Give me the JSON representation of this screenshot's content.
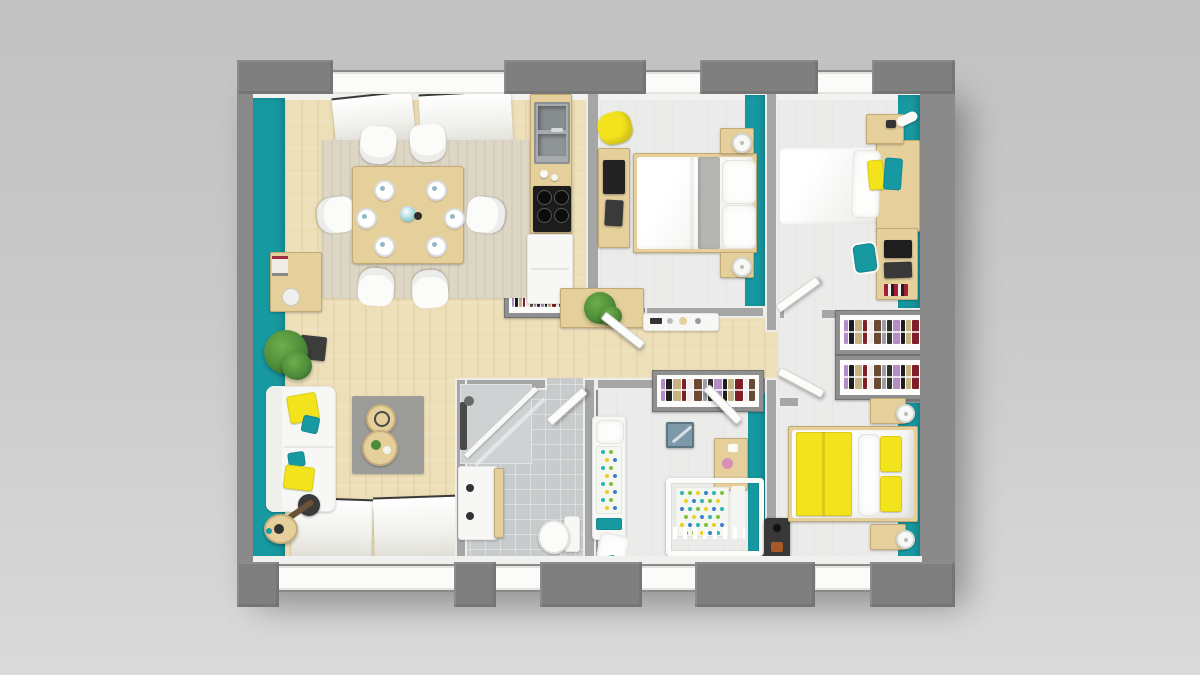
{
  "scene": {
    "type": "3d-floor-plan-top-view",
    "description": "Top-down 3D architectural render of a single-storey house with teal accent walls, light wood floors and yellow furniture accents",
    "text_visible": "none"
  },
  "palette": {
    "background_top": "#c1c1c1",
    "background_mid": "#cccccc",
    "background_bottom": "#dadada",
    "outer_wall": "#8a8a8a",
    "outer_wall_dark": "#7f7f7f",
    "accent_teal": "#1799a1",
    "accent_yellow": "#f3e31d",
    "wood_floor": "#eddfb8",
    "wood_furniture": "#e5cf9b",
    "bedroom_floor": "#ebebea",
    "tile_floor": "#c7cbcc",
    "rug_beige": "#ddd6c4",
    "rug_gray": "#9c9c9a",
    "white_furniture": "#f7f7f5",
    "dark_appliance": "#1c1c1c",
    "plant_green": "#4e8c3a",
    "crib_dots_bg": "#f4f6f0"
  },
  "dining": {
    "chairs": 6,
    "place_settings": 6
  },
  "wardrobes": {
    "racks": 4,
    "clothes_colors": [
      "#b48cc8",
      "#1f1c20",
      "#c7b382",
      "#7e1f2a",
      "#eeeeee",
      "#6a4a33",
      "#9aa0a8",
      "#33302b"
    ]
  },
  "kids_room": {
    "polka_dot_colors": [
      "#2fb0b5",
      "#7fbf3f",
      "#ecd020",
      "#3f7fd0"
    ]
  },
  "rooms": [
    {
      "name": "living-dining-kitchen",
      "furniture": [
        "dining-table",
        "six-white-chairs",
        "tableware",
        "beige-rug",
        "sideboard",
        "potted-plant",
        "white-sofa",
        "yellow-teal-cushions",
        "gray-rug",
        "two-round-coffee-tables",
        "arc-floor-lamp",
        "kitchen-sink",
        "cooktop",
        "refrigerator",
        "plant-console",
        "built-in-wardrobe"
      ]
    },
    {
      "name": "bedroom-top-middle",
      "furniture": [
        "double-bed",
        "two-nightstands-with-lamps",
        "desk",
        "yellow-chair"
      ]
    },
    {
      "name": "bedroom-top-right",
      "furniture": [
        "single-bed",
        "nightstand",
        "desk-with-computer",
        "teal-chair"
      ]
    },
    {
      "name": "hallway",
      "furniture": [
        "wall-console-shelf",
        "wardrobes"
      ]
    },
    {
      "name": "bathroom",
      "furniture": [
        "walk-in-shower",
        "vanity-sink",
        "toilet"
      ]
    },
    {
      "name": "kids-room",
      "furniture": [
        "toddler-bed",
        "crib",
        "shelf-unit",
        "toy-box",
        "wardrobe",
        "floor-cushion"
      ]
    },
    {
      "name": "bedroom-bottom-right",
      "furniture": [
        "double-bed-yellow-duvet",
        "two-nightstands-with-lamps",
        "double-wardrobe",
        "wood-stove"
      ]
    }
  ]
}
